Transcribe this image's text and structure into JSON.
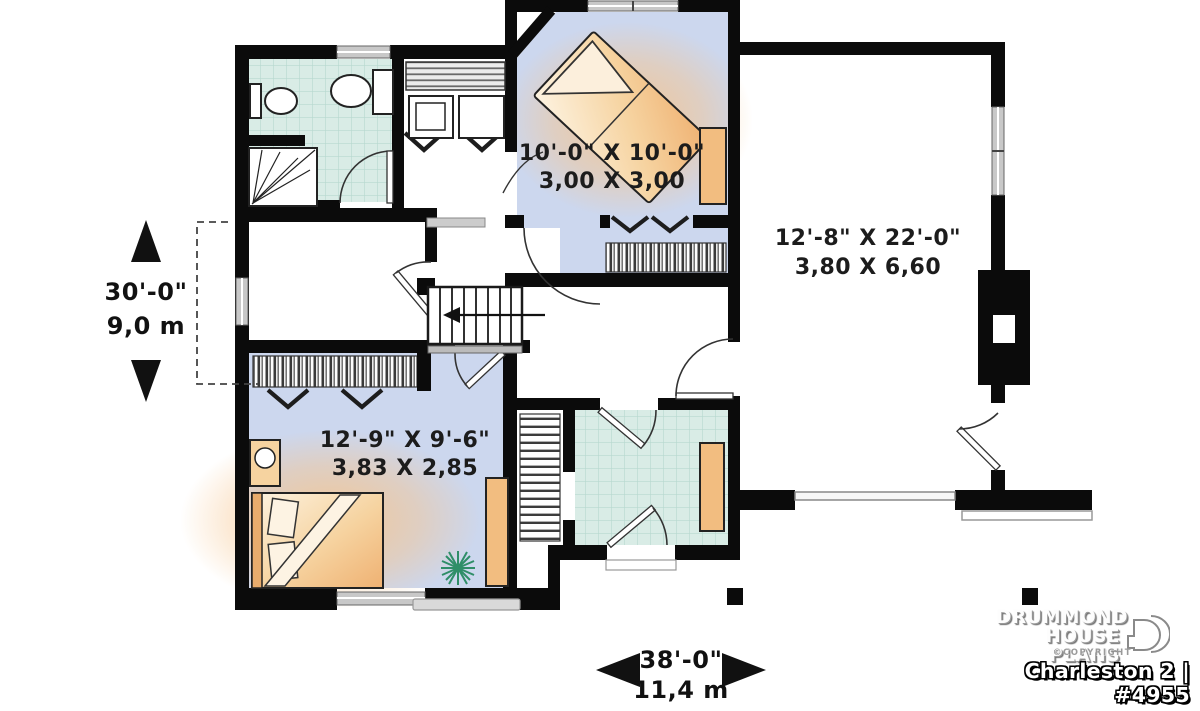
{
  "plan": {
    "rooms": [
      {
        "id": "bedroom-top",
        "dim_imperial": "10'-0\" X 10'-0\"",
        "dim_metric": "3,00 X 3,00"
      },
      {
        "id": "garage",
        "dim_imperial": "12'-8\" X 22'-0\"",
        "dim_metric": "3,80 X 6,60"
      },
      {
        "id": "bedroom-bottom",
        "dim_imperial": "12'-9\" X 9'-6\"",
        "dim_metric": "3,83 X 2,85"
      }
    ],
    "overall": {
      "depth_imperial": "30'-0\"",
      "depth_metric": "9,0 m",
      "width_imperial": "38'-0\"",
      "width_metric": "11,4 m"
    }
  },
  "branding": {
    "name_line1": "DRUMMOND",
    "name_line2": "HOUSE PLANS",
    "copyright": "©COPYRIGHT",
    "plan_title": "Charleston 2 | #4955"
  },
  "colors": {
    "wall": "#0b0b0b",
    "tile_floor": "#d9ece6",
    "blue_floor": "#ccd7ee",
    "furniture_tan": "#f2bd80",
    "plant_green": "#2f8e68",
    "window_gray": "#c8c8c8"
  }
}
